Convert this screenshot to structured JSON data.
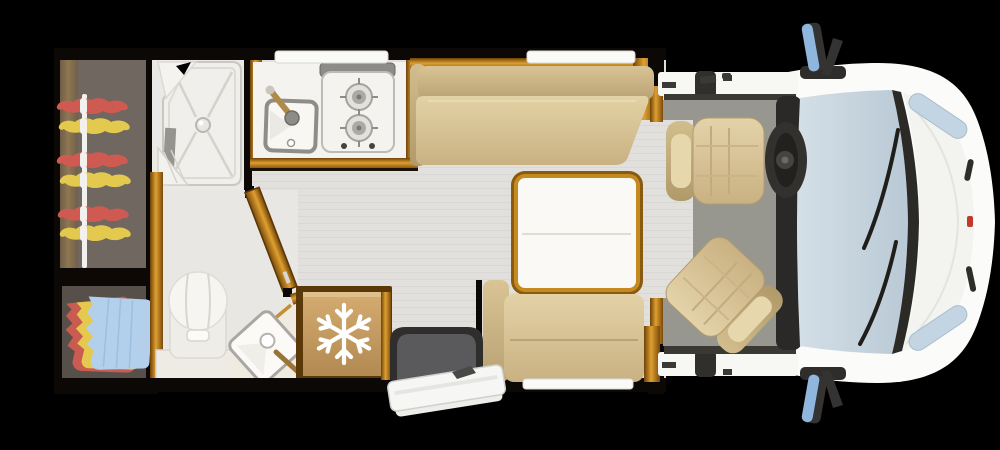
{
  "scene": {
    "type": "motorhome-floor-plan",
    "view": "top-down"
  },
  "palette": {
    "background": "#000000",
    "wall_black": "#0B0806",
    "wood_light": "#E2A335",
    "wood_mid": "#B97A16",
    "wood_dark": "#6E4208",
    "floor_light": "#E1E0DC",
    "floor_stripe": "#D9D8D4",
    "wardrobe_floor": "#6F6760",
    "closet_floor": "#57504A",
    "shower_white": "#F0EFEB",
    "counter_white": "#F4F3EF",
    "upholstery_light": "#DCC99E",
    "upholstery_dark": "#C3AC7C",
    "table_white": "#FAF9F5",
    "table_trim": "#C58A1F",
    "fridge_tan": "#C89F63",
    "icon_white": "#FFFFFF",
    "hanger_red": "#CE5A52",
    "hanger_yellow": "#E3C94E",
    "clothes_red": "#C95B50",
    "clothes_yellow": "#E4C94E",
    "clothes_blue": "#B3CFEC",
    "rail_white": "#F2F1EE",
    "entry_mat_dark": "#2F2E2D",
    "entry_mat_gray": "#5A595B",
    "step_white": "#F6F6F4",
    "cab_floor": "#98978F",
    "cab_seat": "#D9C497",
    "dash_dark": "#2A2927",
    "wiper_dark": "#2B2A27",
    "windshield_blue": "#C7D5DF",
    "mirror_blue": "#8FB6DC",
    "body_white": "#FBFBF9",
    "headlight_blue": "#C3D4E2",
    "detail_red": "#C0392B"
  },
  "floor_plan": {
    "zones": {
      "wardrobe": {
        "items": [
          "hanging-rail",
          "clothes-hangers"
        ],
        "hangers": {
          "red": 3,
          "yellow": 3
        }
      },
      "closet": {
        "items": [
          "folded-clothes-stack"
        ]
      },
      "shower": {
        "items": [
          "shower-tray",
          "drain",
          "shower-head"
        ]
      },
      "bathroom": {
        "items": [
          "toilet",
          "washbasin",
          "basin-faucet",
          "open-door"
        ]
      },
      "kitchen": {
        "items": [
          "sink",
          "sink-faucet",
          "two-burner-hob"
        ],
        "burner_count": 2
      },
      "lounge": {
        "items": [
          "side-bench-sofa",
          "folding-table",
          "travel-seat-bench"
        ]
      },
      "fridge": {
        "items": [
          "refrigerator",
          "snowflake-icon"
        ]
      },
      "entrance": {
        "items": [
          "entry-mat",
          "fold-out-step"
        ]
      },
      "cab": {
        "items": [
          "driver-seat",
          "swivelled-passenger-seat",
          "steering-wheel",
          "dashboard",
          "windshield",
          "wipers",
          "side-mirror-top",
          "side-mirror-bottom",
          "headlights"
        ],
        "seat_count": 2
      }
    }
  }
}
